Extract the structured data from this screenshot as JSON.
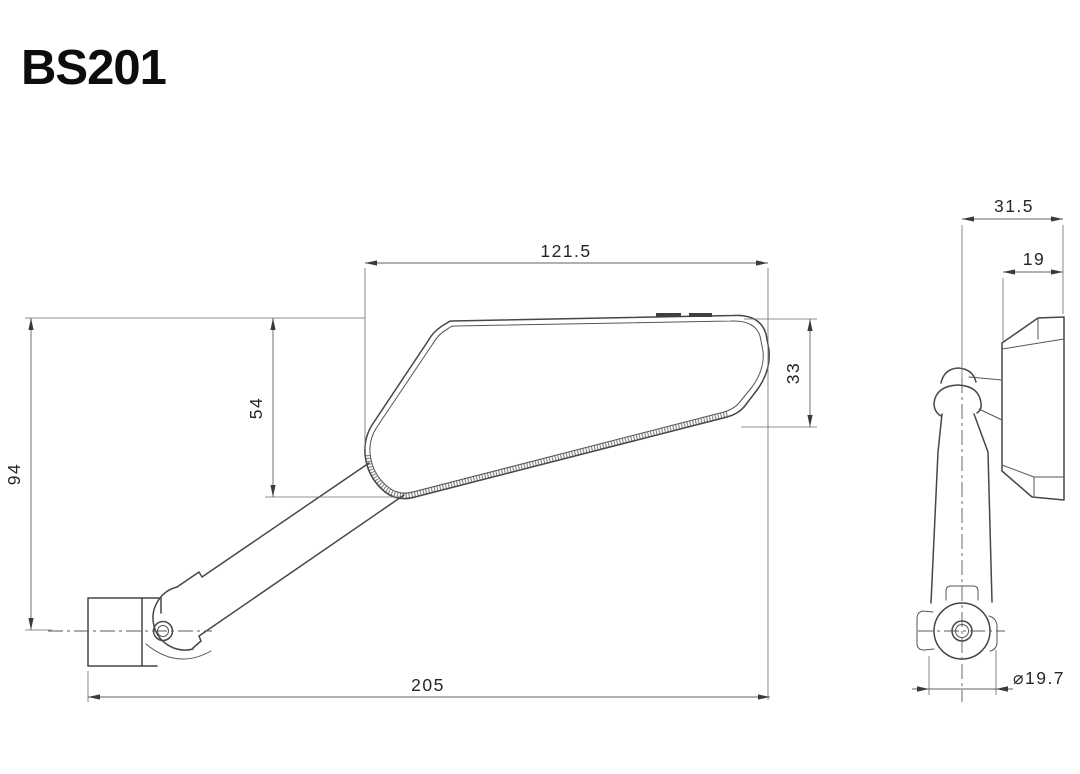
{
  "title": "BS201",
  "side_view": {
    "mirror_width": "121.5",
    "mirror_right_height": "33",
    "mirror_left_height": "54",
    "overall_height": "94",
    "overall_length": "205"
  },
  "front_view": {
    "overall_depth": "31.5",
    "housing_depth": "19",
    "clamp_diameter": "⌀19.7"
  }
}
